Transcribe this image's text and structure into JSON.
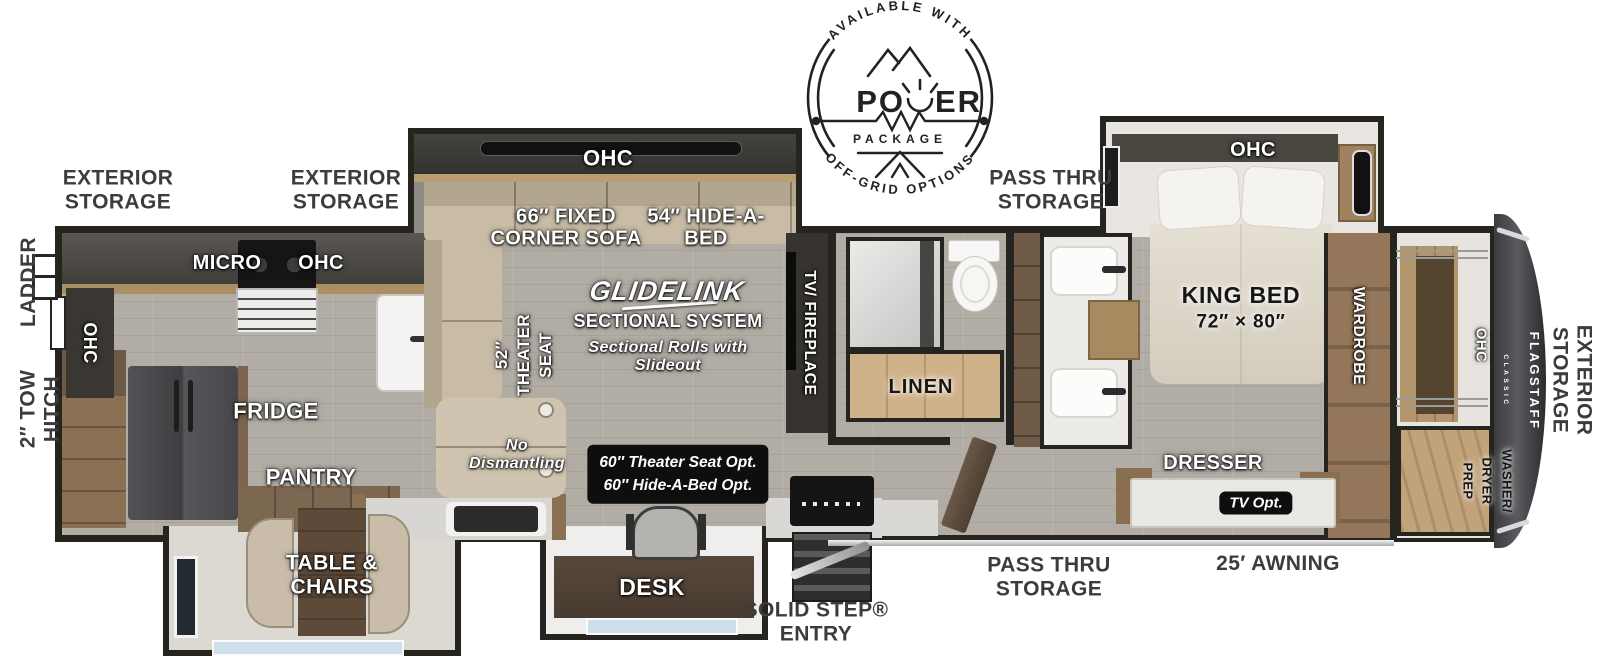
{
  "palette": {
    "wall": "#26241f",
    "floor": "#b1ada5",
    "wood": "#9c7f5d",
    "wood_light": "#c2a379",
    "sofa": "#c8bca7",
    "counter": "#d7d6d3",
    "dark_cabinet": "#3a3733",
    "label_dark": "#3c3c3c",
    "black_box": "#0e0e0e",
    "glass": "#cde0e9"
  },
  "logo": {
    "arc_top": "AVAILABLE WITH",
    "power_left": "PO",
    "power_right": "ER",
    "package": "PACKAGE",
    "arc_bottom": "OFF-GRID OPTIONS"
  },
  "outside": {
    "ladder": "LADDER",
    "tow_hitch": "2″ TOW\nHITCH",
    "exterior_storage_rear_left": "EXTERIOR\nSTORAGE",
    "exterior_storage_rear_right": "EXTERIOR\nSTORAGE",
    "pass_thru_top": "PASS THRU\nSTORAGE",
    "pass_thru_bottom": "PASS THRU\nSTORAGE",
    "awning": "25′ AWNING",
    "solid_step": "SOLID STEP®\nENTRY",
    "exterior_storage_front": "EXTERIOR\nSTORAGE"
  },
  "kitchen": {
    "ohc_left": "OHC",
    "micro": "MICRO",
    "ohc": "OHC",
    "fridge": "FRIDGE",
    "pantry": "PANTRY",
    "table_chairs": "TABLE &\nCHAIRS"
  },
  "living": {
    "ohc": "OHC",
    "corner_sofa": "66″ FIXED\nCORNER SOFA",
    "hide_a_bed": "54″ HIDE-A-\nBED",
    "theater_seat": "52″\nTHEATER\nSEAT",
    "glidelink": "GLIDELINK",
    "sectional_system": "SECTIONAL SYSTEM",
    "sectional_note": "Sectional Rolls with\nSlideout",
    "no_dismantling": "No\nDismantling",
    "options": "60″ Theater Seat Opt.\n60″ Hide-A-Bed Opt.",
    "desk": "DESK",
    "tv_fireplace": "TV/ FIREPLACE"
  },
  "bath": {
    "linen": "LINEN"
  },
  "bedroom": {
    "ohc": "OHC",
    "king_bed": "KING BED",
    "king_size": "72″ × 80″",
    "wardrobe": "WARDROBE",
    "dresser": "DRESSER",
    "tv_opt": "TV Opt."
  },
  "front": {
    "ohc": "OHC",
    "washer_dryer": "WASHER/\nDRYER\nPREP",
    "brand": "FLAGSTAFF",
    "brand_sub": "CLASSIC"
  }
}
